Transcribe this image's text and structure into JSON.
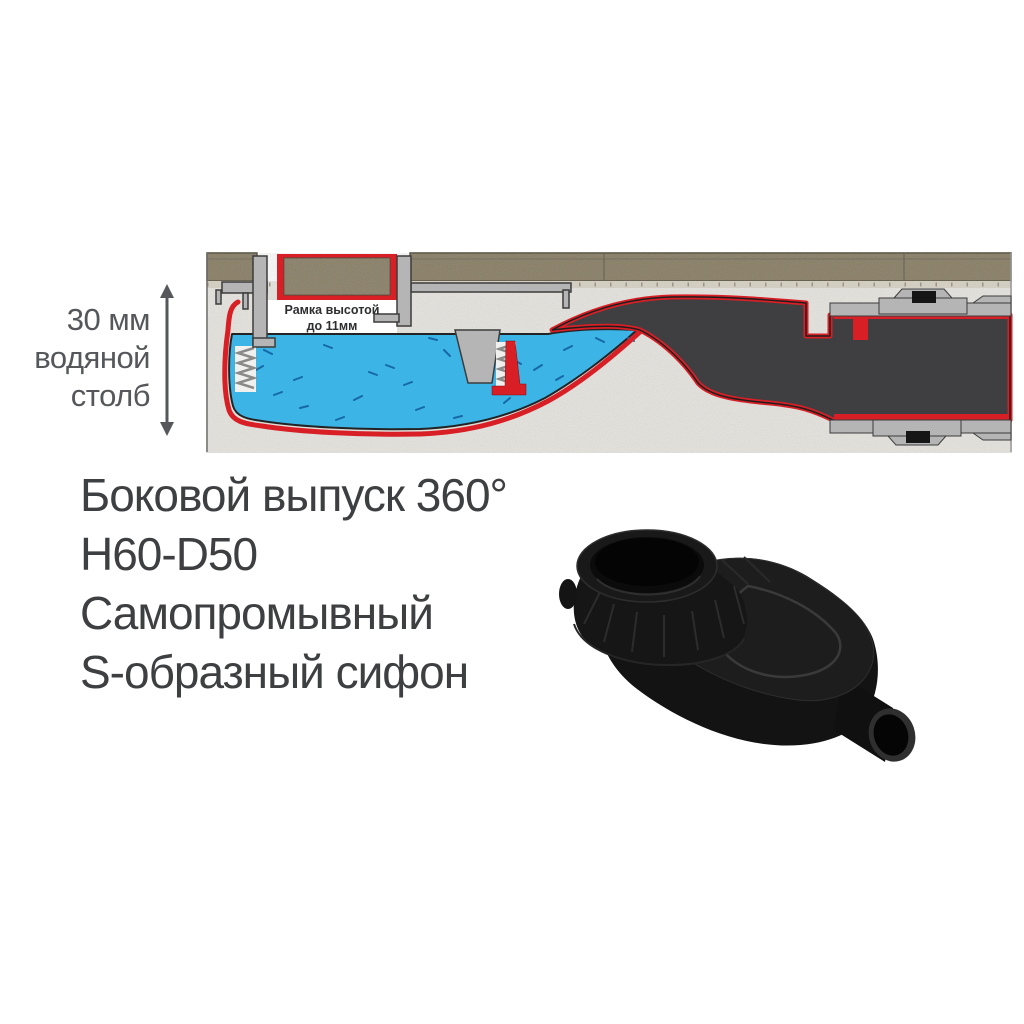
{
  "water_column_label": {
    "lines": [
      "30 мм",
      "водяной",
      "столб"
    ]
  },
  "diagram_frame_label": {
    "lines": [
      "Рамка высотой",
      "до 11мм"
    ]
  },
  "features": {
    "lines": [
      "Боковой выпуск 360°",
      "H60-D50",
      "Самопромывный",
      "S-образный сифон"
    ]
  },
  "visuals": {
    "diagram_name": "shower-channel-drain-cross-section",
    "product_name": "black-plastic-s-trap-siphon",
    "colors": {
      "water_blue": "#3cb4e6",
      "membrane_red": "#d81f26",
      "siphon_dark": "#3f3f41",
      "tile_brown": "#877c63",
      "metal_gray": "#b5b5b5",
      "concrete_light": "#e9e7e2",
      "text_dark": "#3e3f41",
      "label_gray": "#55575a"
    }
  }
}
